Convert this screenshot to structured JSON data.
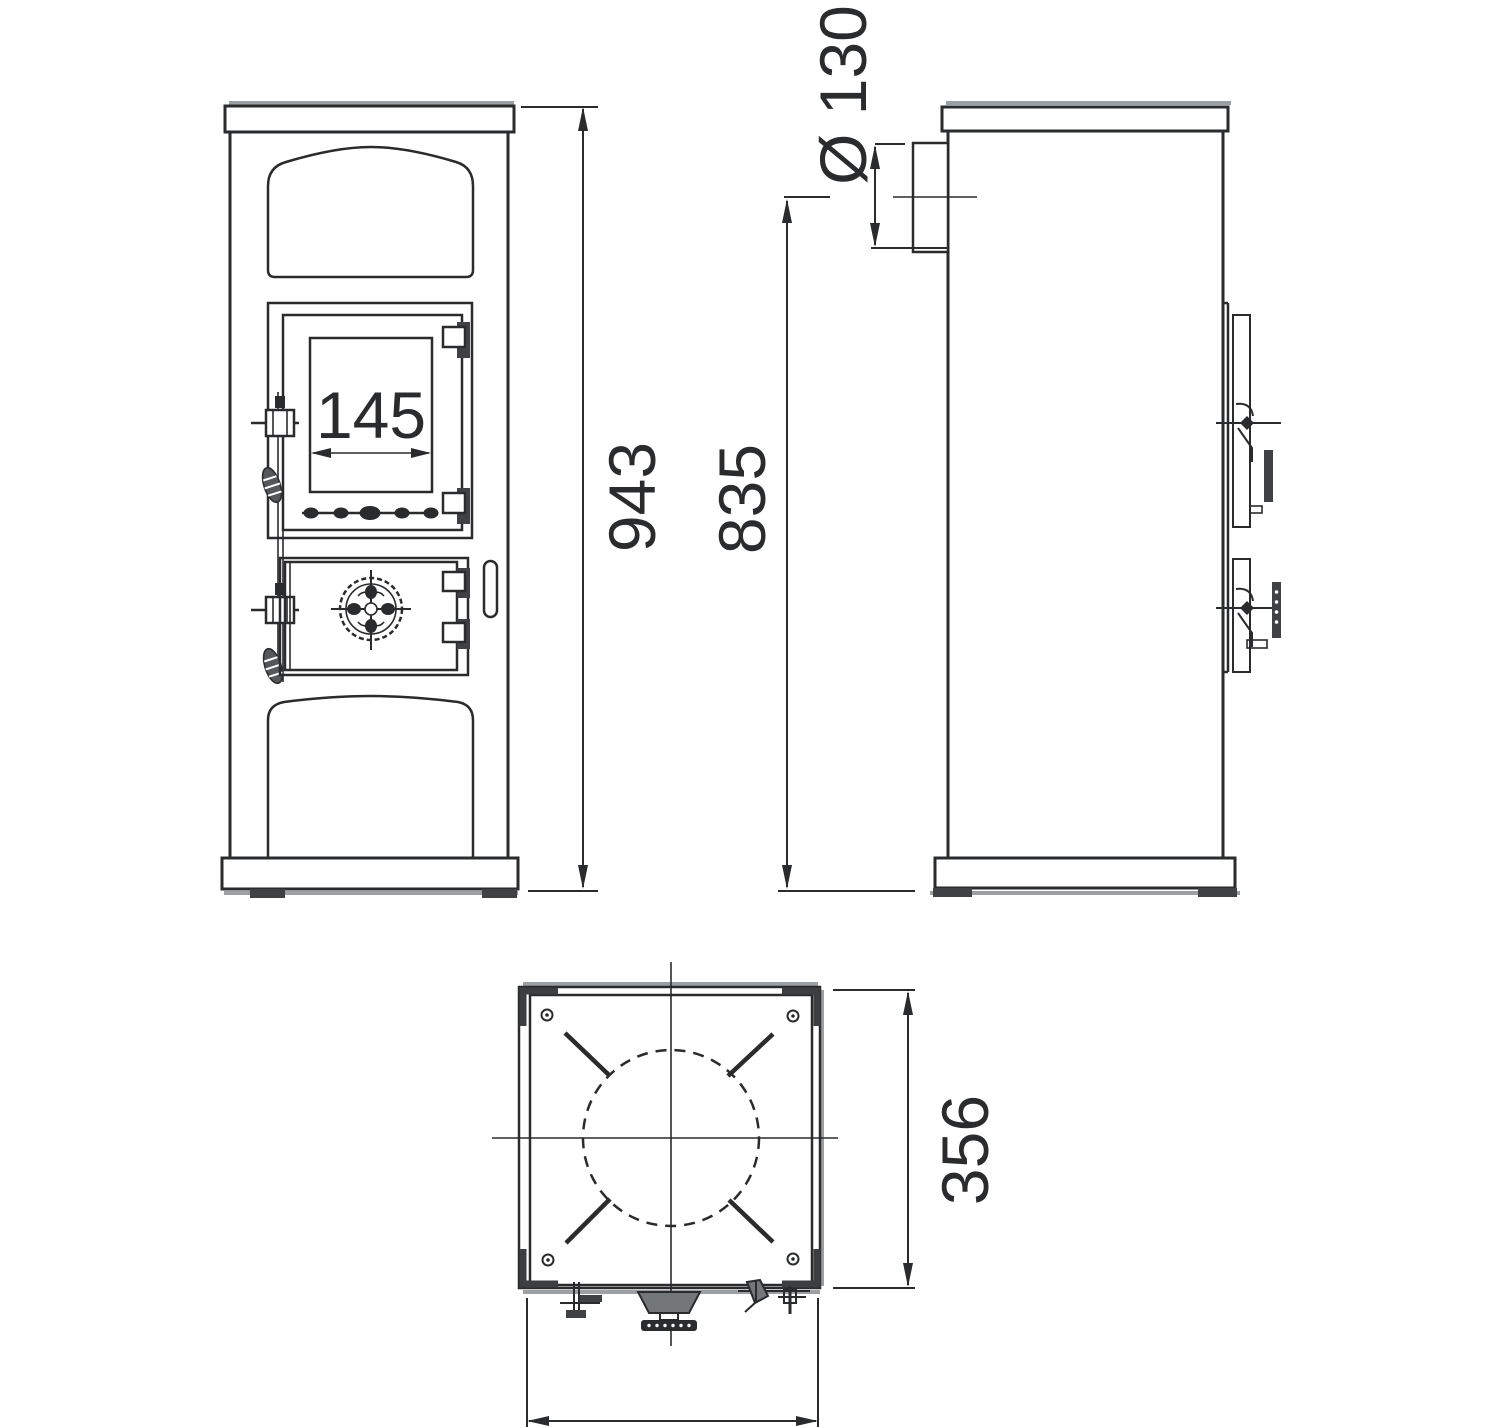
{
  "drawing": {
    "kind": "stove-technical-drawing",
    "views": {
      "front": "front-view",
      "side": "side-view",
      "top": "top-view"
    }
  },
  "annotations": {
    "glass_width": "145",
    "overall_height": "943",
    "flue_height": "835",
    "flue_diameter": "Ø 130",
    "depth": "356"
  },
  "colors": {
    "ink": "#2a2b2d",
    "shadow": "#9da0a3",
    "background": "#ffffff"
  }
}
